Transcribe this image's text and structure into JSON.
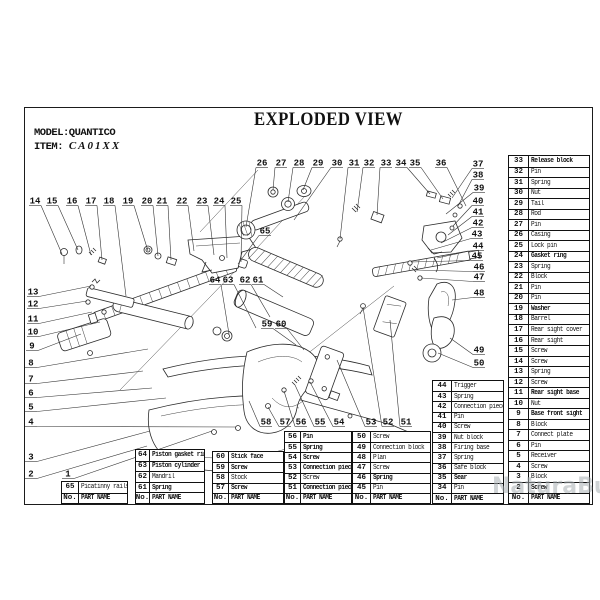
{
  "header": {
    "model": "MODEL:QUANTICO",
    "item_label": "ITEM:",
    "item_value": "CA01XX",
    "title": "EXPLODED VIEW"
  },
  "watermark": {
    "text": "NaturaBuy",
    "color": "#a9b0b4"
  },
  "table_footer": {
    "no": "No.",
    "name": "PART NAME"
  },
  "tables": [
    {
      "id": "t65",
      "left": 61,
      "top": 481,
      "width": 67,
      "numw": 17,
      "rowh": 10.5,
      "rows": [
        [
          "65",
          "Picatinny rails",
          0
        ]
      ]
    },
    {
      "id": "t64",
      "left": 135,
      "top": 449,
      "width": 70,
      "numw": 14,
      "rowh": 10.6,
      "rows": [
        [
          "64",
          "Piston gasket ring",
          1
        ],
        [
          "63",
          "Piston cylinder",
          1
        ],
        [
          "62",
          "Mandril",
          0
        ],
        [
          "61",
          "Spring",
          1
        ]
      ]
    },
    {
      "id": "t60",
      "left": 212,
      "top": 451,
      "width": 72,
      "numw": 16,
      "rowh": 10.2,
      "rows": [
        [
          "60",
          "Stick face",
          1
        ],
        [
          "59",
          "Screw",
          1
        ],
        [
          "58",
          "Stock",
          0
        ],
        [
          "57",
          "Screw",
          1
        ]
      ]
    },
    {
      "id": "t56",
      "left": 284,
      "top": 431,
      "width": 68,
      "numw": 16,
      "rowh": 10.14,
      "rows": [
        [
          "56",
          "Pin",
          1
        ],
        [
          "55",
          "Spring",
          1
        ],
        [
          "54",
          "Screw",
          1
        ],
        [
          "53",
          "Connection piece",
          1
        ],
        [
          "52",
          "Screw",
          0
        ],
        [
          "51",
          "Connection piece",
          1
        ]
      ]
    },
    {
      "id": "t50",
      "left": 352,
      "top": 431,
      "width": 79,
      "numw": 18,
      "rowh": 10.14,
      "rows": [
        [
          "50",
          "Screw",
          0
        ],
        [
          "49",
          "Connection block",
          0
        ],
        [
          "48",
          "Plan",
          0
        ],
        [
          "47",
          "Screw",
          0
        ],
        [
          "46",
          "Spring",
          1
        ],
        [
          "45",
          "Pin",
          0
        ]
      ]
    },
    {
      "id": "t44",
      "left": 432,
      "top": 380,
      "width": 72,
      "numw": 19,
      "rowh": 10.2,
      "rows": [
        [
          "44",
          "Trigger",
          0
        ],
        [
          "43",
          "Spring",
          0
        ],
        [
          "42",
          "Connection piece",
          0
        ],
        [
          "41",
          "Pin",
          0
        ],
        [
          "40",
          "Screw",
          0
        ],
        [
          "39",
          "Nut block",
          0
        ],
        [
          "38",
          "Firing base",
          0
        ],
        [
          "37",
          "Spring",
          0
        ],
        [
          "36",
          "Safe block",
          0
        ],
        [
          "35",
          "Sear",
          1
        ],
        [
          "34",
          "Pin",
          0
        ]
      ]
    },
    {
      "id": "t33",
      "left": 508,
      "top": 155,
      "width": 82,
      "numw": 20,
      "rowh": 10.52,
      "rows": [
        [
          "33",
          "Release block",
          1
        ],
        [
          "32",
          "Pin",
          0
        ],
        [
          "31",
          "Spring",
          0
        ],
        [
          "30",
          "Nut",
          0
        ],
        [
          "29",
          "Tail",
          0
        ],
        [
          "28",
          "Rod",
          0
        ],
        [
          "27",
          "Pin",
          0
        ],
        [
          "26",
          "Casing",
          0
        ],
        [
          "25",
          "Lock pin",
          0
        ],
        [
          "24",
          "Gasket ring",
          1
        ],
        [
          "23",
          "Spring",
          0
        ],
        [
          "22",
          "Block",
          0
        ],
        [
          "21",
          "Pin",
          0
        ],
        [
          "20",
          "Pin",
          0
        ],
        [
          "19",
          "Washer",
          1
        ],
        [
          "18",
          "Barrel",
          0
        ],
        [
          "17",
          "Rear sight cover",
          0
        ],
        [
          "16",
          "Rear sight",
          0
        ],
        [
          "15",
          "Screw",
          0
        ],
        [
          "14",
          "Screw",
          0
        ],
        [
          "13",
          "Spring",
          0
        ],
        [
          "12",
          "Screw",
          0
        ],
        [
          "11",
          "Rear sight base",
          1
        ],
        [
          "10",
          "Nut",
          0
        ],
        [
          "9",
          "Base front sight",
          1
        ],
        [
          "8",
          "Block",
          0
        ],
        [
          "7",
          "Connect plate",
          0
        ],
        [
          "6",
          "Pin",
          0
        ],
        [
          "5",
          "Receiver",
          0
        ],
        [
          "4",
          "Screw",
          0
        ],
        [
          "3",
          "Block",
          0
        ],
        [
          "2",
          "Screw",
          1
        ]
      ]
    }
  ],
  "callouts": [
    [
      "14",
      35,
      200,
      62,
      254
    ],
    [
      "15",
      52,
      200,
      78,
      250
    ],
    [
      "16",
      72,
      200,
      91,
      255
    ],
    [
      "17",
      91,
      200,
      102,
      260
    ],
    [
      "18",
      109,
      200,
      126,
      296
    ],
    [
      "19",
      128,
      200,
      148,
      251
    ],
    [
      "20",
      147,
      200,
      158,
      256
    ],
    [
      "21",
      162,
      200,
      171,
      260
    ],
    [
      "22",
      182,
      200,
      194,
      251
    ],
    [
      "23",
      202,
      200,
      214,
      255
    ],
    [
      "24",
      219,
      200,
      227,
      258
    ],
    [
      "25",
      236,
      200,
      241,
      262
    ],
    [
      "26",
      262,
      162,
      246,
      227
    ],
    [
      "27",
      281,
      162,
      273,
      190
    ],
    [
      "28",
      299,
      162,
      288,
      202
    ],
    [
      "29",
      318,
      162,
      303,
      190
    ],
    [
      "30",
      337,
      162,
      294,
      220
    ],
    [
      "31",
      354,
      162,
      340,
      239
    ],
    [
      "32",
      369,
      162,
      357,
      212
    ],
    [
      "33",
      386,
      162,
      377,
      215
    ],
    [
      "34",
      401,
      162,
      430,
      194
    ],
    [
      "35",
      415,
      162,
      443,
      199
    ],
    [
      "36",
      441,
      162,
      466,
      206
    ],
    [
      "37",
      478,
      163,
      452,
      198
    ],
    [
      "38",
      478,
      174,
      458,
      206
    ],
    [
      "39",
      479,
      187,
      446,
      214
    ],
    [
      "40",
      478,
      200,
      453,
      226
    ],
    [
      "41",
      478,
      211,
      448,
      235
    ],
    [
      "42",
      478,
      222,
      441,
      243
    ],
    [
      "43",
      477,
      233,
      431,
      250
    ],
    [
      "44",
      478,
      245,
      437,
      258
    ],
    [
      "45",
      477,
      255,
      411,
      262
    ],
    [
      "46",
      479,
      266,
      415,
      270
    ],
    [
      "47",
      479,
      276,
      421,
      278
    ],
    [
      "48",
      479,
      292,
      452,
      300
    ],
    [
      "49",
      479,
      349,
      450,
      338
    ],
    [
      "50",
      479,
      362,
      438,
      353
    ],
    [
      "13",
      33,
      291,
      91,
      286
    ],
    [
      "12",
      33,
      303,
      87,
      301
    ],
    [
      "11",
      33,
      318,
      92,
      312
    ],
    [
      "10",
      33,
      331,
      100,
      322
    ],
    [
      "9",
      32,
      345,
      81,
      334
    ],
    [
      "8",
      31,
      362,
      148,
      349
    ],
    [
      "7",
      31,
      378,
      143,
      371
    ],
    [
      "6",
      31,
      392,
      152,
      388
    ],
    [
      "5",
      31,
      406,
      166,
      398
    ],
    [
      "4",
      31,
      421,
      236,
      427
    ],
    [
      "3",
      31,
      456,
      150,
      431
    ],
    [
      "2",
      31,
      473,
      147,
      446
    ],
    [
      "1",
      68,
      473,
      212,
      431
    ],
    [
      "65",
      265,
      230,
      238,
      264
    ],
    [
      "64",
      215,
      279,
      229,
      334
    ],
    [
      "63",
      228,
      279,
      256,
      328
    ],
    [
      "62",
      245,
      279,
      270,
      317
    ],
    [
      "61",
      258,
      279,
      283,
      297
    ],
    [
      "59",
      267,
      323,
      296,
      345
    ],
    [
      "60",
      281,
      323,
      304,
      350
    ],
    [
      "58",
      266,
      421,
      249,
      401
    ],
    [
      "57",
      285,
      421,
      268,
      407
    ],
    [
      "56",
      301,
      421,
      284,
      391
    ],
    [
      "55",
      320,
      421,
      295,
      385
    ],
    [
      "54",
      339,
      421,
      310,
      382
    ],
    [
      "53",
      371,
      421,
      337,
      360
    ],
    [
      "52",
      388,
      421,
      363,
      307
    ],
    [
      "51",
      406,
      421,
      390,
      320
    ]
  ]
}
